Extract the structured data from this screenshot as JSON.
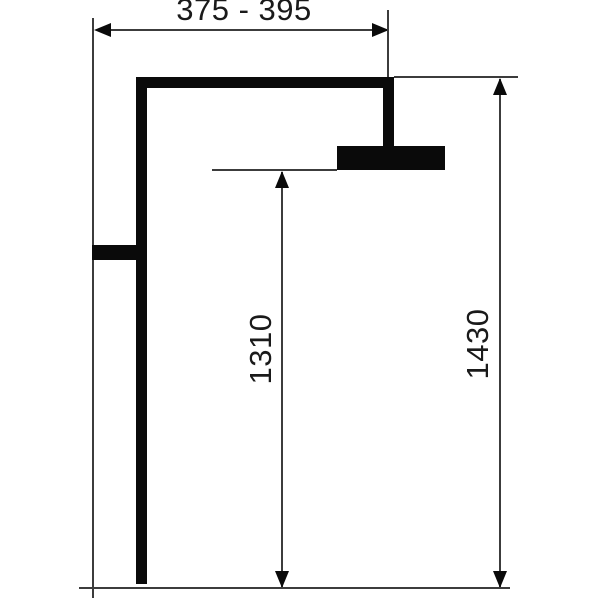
{
  "diagram": {
    "kind": "technical-dimension-drawing",
    "dimensions": {
      "top_width_range": "375 - 395",
      "head_to_floor_height": "1310",
      "arm_to_floor_height": "1430"
    },
    "colors": {
      "background": "#ffffff",
      "fixture": "#0a0a0a",
      "dimension_lines": "#3c3c3c",
      "text": "#1a1a1a"
    }
  }
}
